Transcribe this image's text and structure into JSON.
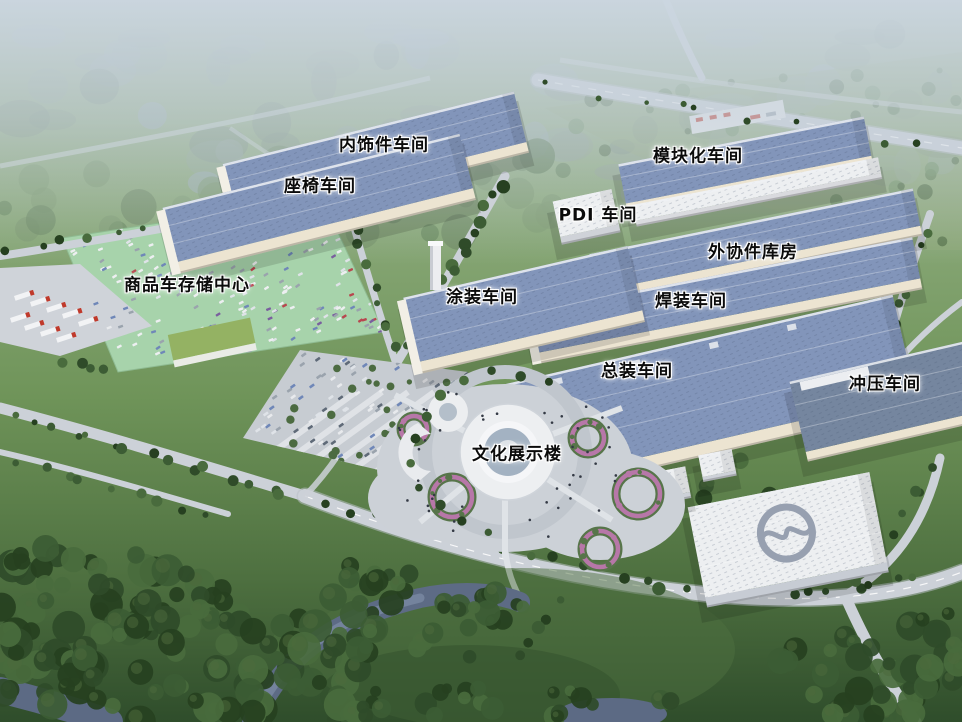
{
  "scene": {
    "kind": "aerial-factory-campus-rendering"
  },
  "labels": [
    {
      "id": "interior-trim-workshop",
      "text": "内饰件车间",
      "x": 384,
      "y": 143
    },
    {
      "id": "seat-workshop",
      "text": "座椅车间",
      "x": 320,
      "y": 184
    },
    {
      "id": "modular-workshop",
      "text": "模块化车间",
      "x": 698,
      "y": 154
    },
    {
      "id": "pdi-workshop",
      "text": "PDI 车间",
      "x": 598,
      "y": 213
    },
    {
      "id": "outsourced-parts-warehouse",
      "text": "外协件库房",
      "x": 753,
      "y": 250
    },
    {
      "id": "vehicle-storage-center",
      "text": "商品车存储中心",
      "x": 187,
      "y": 283
    },
    {
      "id": "paint-workshop",
      "text": "涂装车间",
      "x": 482,
      "y": 295
    },
    {
      "id": "welding-workshop",
      "text": "焊装车间",
      "x": 691,
      "y": 299
    },
    {
      "id": "final-assembly-workshop",
      "text": "总装车间",
      "x": 637,
      "y": 369
    },
    {
      "id": "stamping-workshop",
      "text": "冲压车间",
      "x": 885,
      "y": 382
    },
    {
      "id": "culture-exhibition-building",
      "text": "文化展示楼",
      "x": 517,
      "y": 452
    }
  ],
  "colors": {
    "roof_blue": "#8295ba",
    "roof_blue_dark": "#75869f",
    "wall_cream": "#ece4d1",
    "wall_shade": "#d7cfbc",
    "white_bldg": "#edeff1",
    "white_wall": "#ccd1d8",
    "lot_green": "#a7d3ab",
    "grass": "#7aa065",
    "grass_dark": "#4e7040",
    "forest_dark": "#2d4729",
    "road": "#ccd1d8",
    "road_light": "#dfe3e7",
    "water": "#66748e",
    "haze": "#c7d2dd",
    "plaza": "#ccd1d7",
    "glass_blue": "#a3b2c2",
    "flower_pink": "#b777a8",
    "hedge_green": "#57754a",
    "car_red": "#b8474f",
    "car_blue": "#6f87b8",
    "truck_red": "#c0392b",
    "label_text": "#0b0b0b",
    "label_halo": "#ffffff"
  }
}
